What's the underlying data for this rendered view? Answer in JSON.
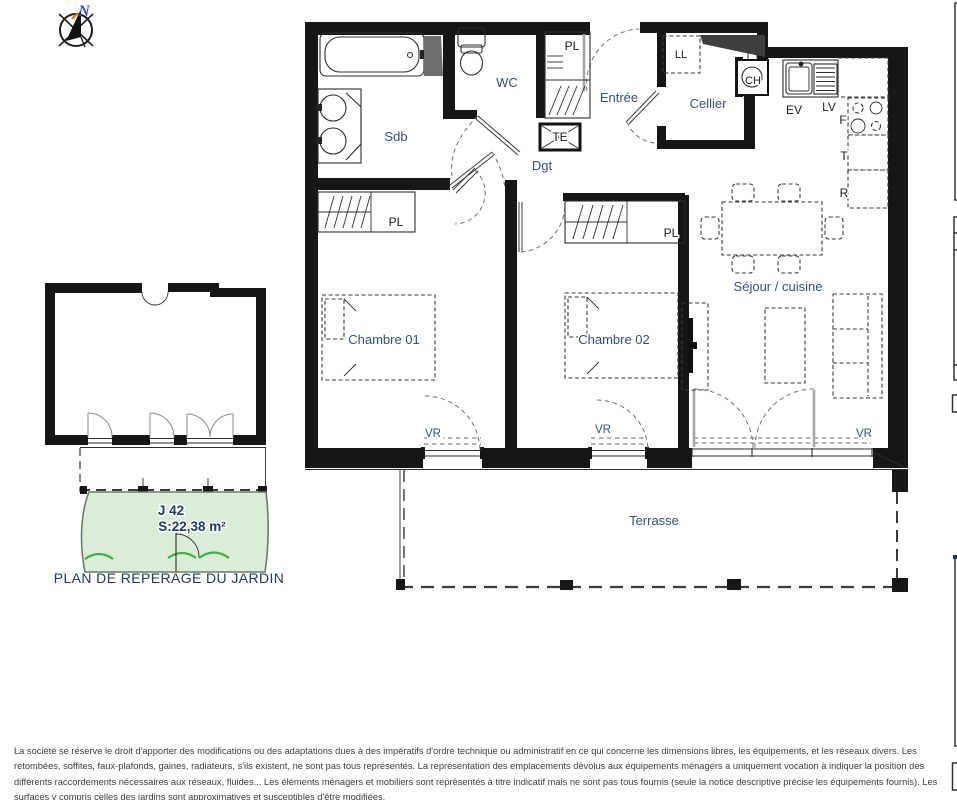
{
  "colors": {
    "wall": "#161616",
    "room_label": "#33517e",
    "code_label": "#1c1c1c",
    "garden_fill": "#dcedd7",
    "garden_stroke": "#6b7b6b",
    "hedge_green": "#3faf46",
    "north_blue": "#3a50c8",
    "north_accent": "#e07820",
    "caption_navy": "#1f3a67",
    "disclaimer_gray": "#3c3c3c"
  },
  "compass": {
    "north": "N"
  },
  "plan": {
    "rooms": {
      "sdb": "Sdb",
      "wc": "WC",
      "entree": "Entrée",
      "dgt": "Dgt",
      "cellier": "Cellier",
      "chambre1": "Chambre 01",
      "chambre2": "Chambre 02",
      "sejour": "Séjour / cuisine",
      "terrasse": "Terrasse"
    },
    "codes": {
      "pl": "PL",
      "te": "TE",
      "ll": "LL",
      "ch": "CH",
      "ev": "EV",
      "lv": "LV",
      "f": "F",
      "t": "T",
      "r": "R",
      "vr": "VR"
    }
  },
  "garden": {
    "id": "J 42",
    "surface": "S:22,38 m²",
    "caption": "PLAN DE REPERAGE DU JARDIN"
  },
  "disclaimer": {
    "text": "La société se réserve le droit d'apporter des modifications ou des adaptations dues à des impératifs d'ordre technique ou administratif en ce qui concerne les dimensions libres, les équipements, et les réseaux divers. Les retombées, soffites, faux-plafonds, gaines, radiateurs, s'ils existent, ne sont pas tous représentés. La représentation des emplacements dévolus aux équipements ménagers a uniquement vocation à indiquer la position des différents raccordements nécessaires aux réseaux, fluides... Les éléments ménagers et mobiliers sont représentés à titre indicatif mais ne sont pas tous fournis (seule la notice descriptive précise les équipements fournis). Les surfaces y compris celles des jardins sont approximatives et susceptibles d'être modifiées."
  }
}
